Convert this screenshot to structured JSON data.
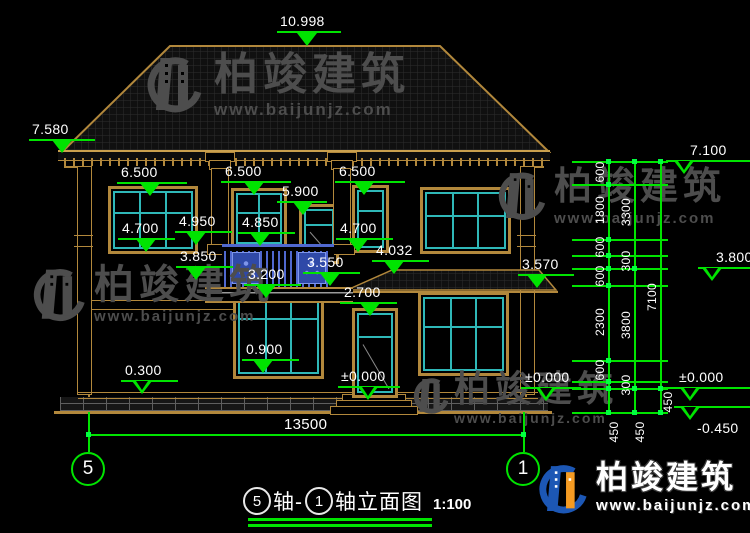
{
  "watermark": {
    "brand": "柏竣建筑",
    "url": "www.baijunjz.com"
  },
  "title": {
    "bubble_left": "5",
    "text_mid": "轴-",
    "bubble_right": "1",
    "text_name": "轴立面图",
    "scale": "1:100"
  },
  "axis_bubbles": {
    "left": "5",
    "right": "1"
  },
  "colors": {
    "dim_green": "#00e400",
    "line_tan": "#b2883c",
    "frame_teal": "#2fb8b8",
    "railing_blue": "#5068cf",
    "wm_gray": "#4d4d4d",
    "logo_blue": "#1c57b5",
    "logo_orange": "#f59b22"
  },
  "overall_width_mm": "13500",
  "annotations": {
    "labels": [
      {
        "t": "10.998",
        "x": 280,
        "y": 13
      },
      {
        "t": "7.580",
        "x": 32,
        "y": 121
      },
      {
        "t": "6.500",
        "x": 121,
        "y": 164
      },
      {
        "t": "6.500",
        "x": 225,
        "y": 163
      },
      {
        "t": "6.500",
        "x": 339,
        "y": 163
      },
      {
        "t": "5.900",
        "x": 282,
        "y": 183
      },
      {
        "t": "4.700",
        "x": 122,
        "y": 220
      },
      {
        "t": "4.950",
        "x": 179,
        "y": 213
      },
      {
        "t": "4.850",
        "x": 242,
        "y": 214
      },
      {
        "t": "4.700",
        "x": 340,
        "y": 220
      },
      {
        "t": "3.850",
        "x": 180,
        "y": 248
      },
      {
        "t": "3.200",
        "x": 248,
        "y": 266
      },
      {
        "t": "3.550",
        "x": 307,
        "y": 254
      },
      {
        "t": "4.032",
        "x": 376,
        "y": 242
      },
      {
        "t": "3.570",
        "x": 522,
        "y": 256
      },
      {
        "t": "2.700",
        "x": 344,
        "y": 284
      },
      {
        "t": "0.900",
        "x": 246,
        "y": 341
      },
      {
        "t": "0.300",
        "x": 125,
        "y": 362
      },
      {
        "t": "±0.000",
        "x": 341,
        "y": 368
      },
      {
        "t": "±0.000",
        "x": 525,
        "y": 369
      },
      {
        "t": "13500",
        "x": 284,
        "y": 416,
        "s": 15
      },
      {
        "t": "7.100",
        "x": 690,
        "y": 142
      },
      {
        "t": "3.800",
        "x": 716,
        "y": 249
      },
      {
        "t": "±0.000",
        "x": 679,
        "y": 369
      },
      {
        "t": "-0.450",
        "x": 697,
        "y": 420
      },
      {
        "t": "600",
        "cx": 600,
        "cy": 172,
        "r": 1
      },
      {
        "t": "1800",
        "cx": 600,
        "cy": 210,
        "r": 1
      },
      {
        "t": "600",
        "cx": 600,
        "cy": 247,
        "r": 1
      },
      {
        "t": "600",
        "cx": 600,
        "cy": 276,
        "r": 1
      },
      {
        "t": "2300",
        "cx": 600,
        "cy": 322,
        "r": 1
      },
      {
        "t": "600",
        "cx": 600,
        "cy": 370,
        "r": 1
      },
      {
        "t": "450",
        "cx": 614,
        "cy": 432,
        "r": 1
      },
      {
        "t": "3300",
        "cx": 626,
        "cy": 212,
        "r": 1
      },
      {
        "t": "300",
        "cx": 626,
        "cy": 261,
        "r": 1
      },
      {
        "t": "3800",
        "cx": 626,
        "cy": 325,
        "r": 1
      },
      {
        "t": "300",
        "cx": 626,
        "cy": 385,
        "r": 1
      },
      {
        "t": "450",
        "cx": 640,
        "cy": 432,
        "r": 1
      },
      {
        "t": "7100",
        "cx": 652,
        "cy": 297,
        "r": 1
      },
      {
        "t": "450",
        "cx": 668,
        "cy": 402,
        "r": 1
      }
    ],
    "hlines": [
      {
        "x": 277,
        "y": 31,
        "w": 64
      },
      {
        "x": 29,
        "y": 139,
        "w": 66
      },
      {
        "x": 117,
        "y": 182,
        "w": 70
      },
      {
        "x": 221,
        "y": 181,
        "w": 70
      },
      {
        "x": 335,
        "y": 181,
        "w": 70
      },
      {
        "x": 277,
        "y": 201,
        "w": 50
      },
      {
        "x": 118,
        "y": 238,
        "w": 57
      },
      {
        "x": 175,
        "y": 231,
        "w": 57
      },
      {
        "x": 238,
        "y": 232,
        "w": 57
      },
      {
        "x": 336,
        "y": 238,
        "w": 57
      },
      {
        "x": 176,
        "y": 266,
        "w": 57
      },
      {
        "x": 244,
        "y": 284,
        "w": 57
      },
      {
        "x": 303,
        "y": 272,
        "w": 57
      },
      {
        "x": 372,
        "y": 260,
        "w": 57
      },
      {
        "x": 518,
        "y": 274,
        "w": 56
      },
      {
        "x": 340,
        "y": 302,
        "w": 57
      },
      {
        "x": 242,
        "y": 359,
        "w": 57
      },
      {
        "x": 121,
        "y": 380,
        "w": 57
      },
      {
        "x": 338,
        "y": 386,
        "w": 62
      },
      {
        "x": 521,
        "y": 387,
        "w": 60
      },
      {
        "x": 88,
        "y": 434,
        "w": 435
      },
      {
        "x": 666,
        "y": 160,
        "w": 84
      },
      {
        "x": 698,
        "y": 267,
        "w": 52
      },
      {
        "x": 658,
        "y": 387,
        "w": 92
      },
      {
        "x": 674,
        "y": 406,
        "w": 76
      },
      {
        "x": 572,
        "y": 161,
        "w": 96
      },
      {
        "x": 572,
        "y": 184,
        "w": 96
      },
      {
        "x": 572,
        "y": 239,
        "w": 96
      },
      {
        "x": 572,
        "y": 255,
        "w": 96
      },
      {
        "x": 572,
        "y": 268,
        "w": 96
      },
      {
        "x": 572,
        "y": 285,
        "w": 96
      },
      {
        "x": 572,
        "y": 360,
        "w": 96
      },
      {
        "x": 572,
        "y": 381,
        "w": 96
      },
      {
        "x": 572,
        "y": 388,
        "w": 96
      },
      {
        "x": 572,
        "y": 412,
        "w": 96
      },
      {
        "x": 248,
        "y": 518,
        "w": 184,
        "h": 2.5
      },
      {
        "x": 248,
        "y": 524,
        "w": 184,
        "h": 2.5
      }
    ],
    "vlines": [
      {
        "x": 608,
        "y": 161,
        "h": 251
      },
      {
        "x": 634,
        "y": 161,
        "h": 251
      },
      {
        "x": 660,
        "y": 161,
        "h": 251
      },
      {
        "x": 88,
        "y": 412,
        "h": 40
      },
      {
        "x": 523,
        "y": 412,
        "h": 40
      }
    ],
    "triangles": [
      {
        "cx": 307,
        "cy": 33,
        "f": 1
      },
      {
        "cx": 62,
        "cy": 140,
        "f": 1
      },
      {
        "cx": 150,
        "cy": 183,
        "f": 1
      },
      {
        "cx": 254,
        "cy": 182,
        "f": 1
      },
      {
        "cx": 364,
        "cy": 182,
        "f": 1
      },
      {
        "cx": 303,
        "cy": 202,
        "f": 1
      },
      {
        "cx": 146,
        "cy": 239,
        "f": 1
      },
      {
        "cx": 196,
        "cy": 232,
        "f": 1
      },
      {
        "cx": 260,
        "cy": 233,
        "f": 1
      },
      {
        "cx": 358,
        "cy": 239,
        "f": 1
      },
      {
        "cx": 196,
        "cy": 267,
        "f": 1
      },
      {
        "cx": 266,
        "cy": 285,
        "f": 1
      },
      {
        "cx": 330,
        "cy": 273,
        "f": 1
      },
      {
        "cx": 394,
        "cy": 261,
        "f": 1
      },
      {
        "cx": 537,
        "cy": 275,
        "f": 1
      },
      {
        "cx": 370,
        "cy": 303,
        "f": 1
      },
      {
        "cx": 263,
        "cy": 360,
        "f": 1
      },
      {
        "cx": 142,
        "cy": 381,
        "f": 0
      },
      {
        "cx": 368,
        "cy": 387,
        "f": 0
      },
      {
        "cx": 546,
        "cy": 388,
        "f": 0
      },
      {
        "cx": 684,
        "cy": 161,
        "f": 0
      },
      {
        "cx": 712,
        "cy": 268,
        "f": 0
      },
      {
        "cx": 690,
        "cy": 388,
        "f": 0
      },
      {
        "cx": 690,
        "cy": 407,
        "f": 0
      }
    ],
    "ticks": [
      {
        "x": 608,
        "y": 161
      },
      {
        "x": 608,
        "y": 184
      },
      {
        "x": 608,
        "y": 239
      },
      {
        "x": 608,
        "y": 255
      },
      {
        "x": 608,
        "y": 268
      },
      {
        "x": 608,
        "y": 285
      },
      {
        "x": 608,
        "y": 360
      },
      {
        "x": 608,
        "y": 381
      },
      {
        "x": 608,
        "y": 388
      },
      {
        "x": 608,
        "y": 412
      },
      {
        "x": 634,
        "y": 161
      },
      {
        "x": 634,
        "y": 268
      },
      {
        "x": 634,
        "y": 388
      },
      {
        "x": 634,
        "y": 412
      },
      {
        "x": 660,
        "y": 161
      },
      {
        "x": 660,
        "y": 388
      },
      {
        "x": 660,
        "y": 412
      },
      {
        "x": 88,
        "y": 434
      },
      {
        "x": 523,
        "y": 434
      }
    ]
  },
  "building": {
    "windows": [
      {
        "x": 108,
        "y": 186,
        "w": 84,
        "h": 62,
        "cols": 3,
        "hp": 36
      },
      {
        "x": 231,
        "y": 188,
        "w": 50,
        "h": 55,
        "cols": 2,
        "hp": 36
      },
      {
        "x": 299,
        "y": 204,
        "w": 34,
        "h": 54,
        "cols": 1,
        "hp": 28,
        "door": 1
      },
      {
        "x": 352,
        "y": 185,
        "w": 31,
        "h": 62,
        "cols": 1,
        "hp": 33
      },
      {
        "x": 420,
        "y": 187,
        "w": 85,
        "h": 61,
        "cols": 3,
        "hp": 40
      },
      {
        "x": 233,
        "y": 285,
        "w": 85,
        "h": 88,
        "cols": 3,
        "hp": 33
      },
      {
        "x": 418,
        "y": 292,
        "w": 85,
        "h": 78,
        "cols": 3,
        "hp": 38
      },
      {
        "x": 352,
        "y": 308,
        "w": 40,
        "h": 84,
        "cols": 1,
        "hp": 28,
        "door": 1
      }
    ],
    "columns": [
      {
        "x": 205
      },
      {
        "x": 327
      }
    ]
  }
}
